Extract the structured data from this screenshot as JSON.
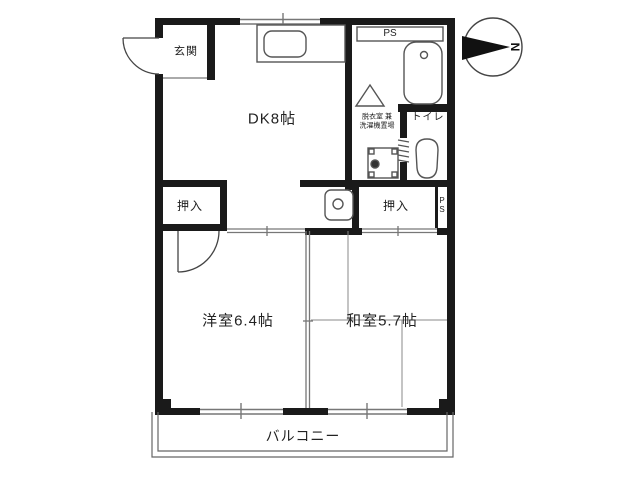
{
  "document": {
    "type": "apartment-floor-plan",
    "orientation_note": "north-arrow-points-right"
  },
  "labels": {
    "genkan": "玄関",
    "dk": "DK8帖",
    "ps_top": "PS",
    "dressing_line1": "脱衣室 兼",
    "dressing_line2": "洗濯機置場",
    "toilet": "トイレ",
    "closet_left": "押入",
    "closet_right": "押入",
    "ps_side": "PS",
    "western_room": "洋室6.4帖",
    "japanese_room": "和室5.7帖",
    "balcony": "バルコニー",
    "compass_north": "N"
  },
  "rooms": [
    {
      "name": "玄関",
      "type": "entrance"
    },
    {
      "name": "DK",
      "size_jo": "8帖"
    },
    {
      "name": "洋室",
      "size_jo": "6.4帖"
    },
    {
      "name": "和室",
      "size_jo": "5.7帖"
    },
    {
      "name": "トイレ",
      "type": "toilet"
    },
    {
      "name": "脱衣室 兼 洗濯機置場",
      "type": "dressing-laundry"
    },
    {
      "name": "押入",
      "count": 2
    },
    {
      "name": "バルコニー",
      "type": "balcony"
    },
    {
      "name": "PS",
      "count": 2
    }
  ],
  "colors": {
    "wall": "#1a1a1a",
    "fixture_line": "#555555",
    "thin_line": "#777777",
    "background": "#ffffff",
    "text": "#222222"
  }
}
